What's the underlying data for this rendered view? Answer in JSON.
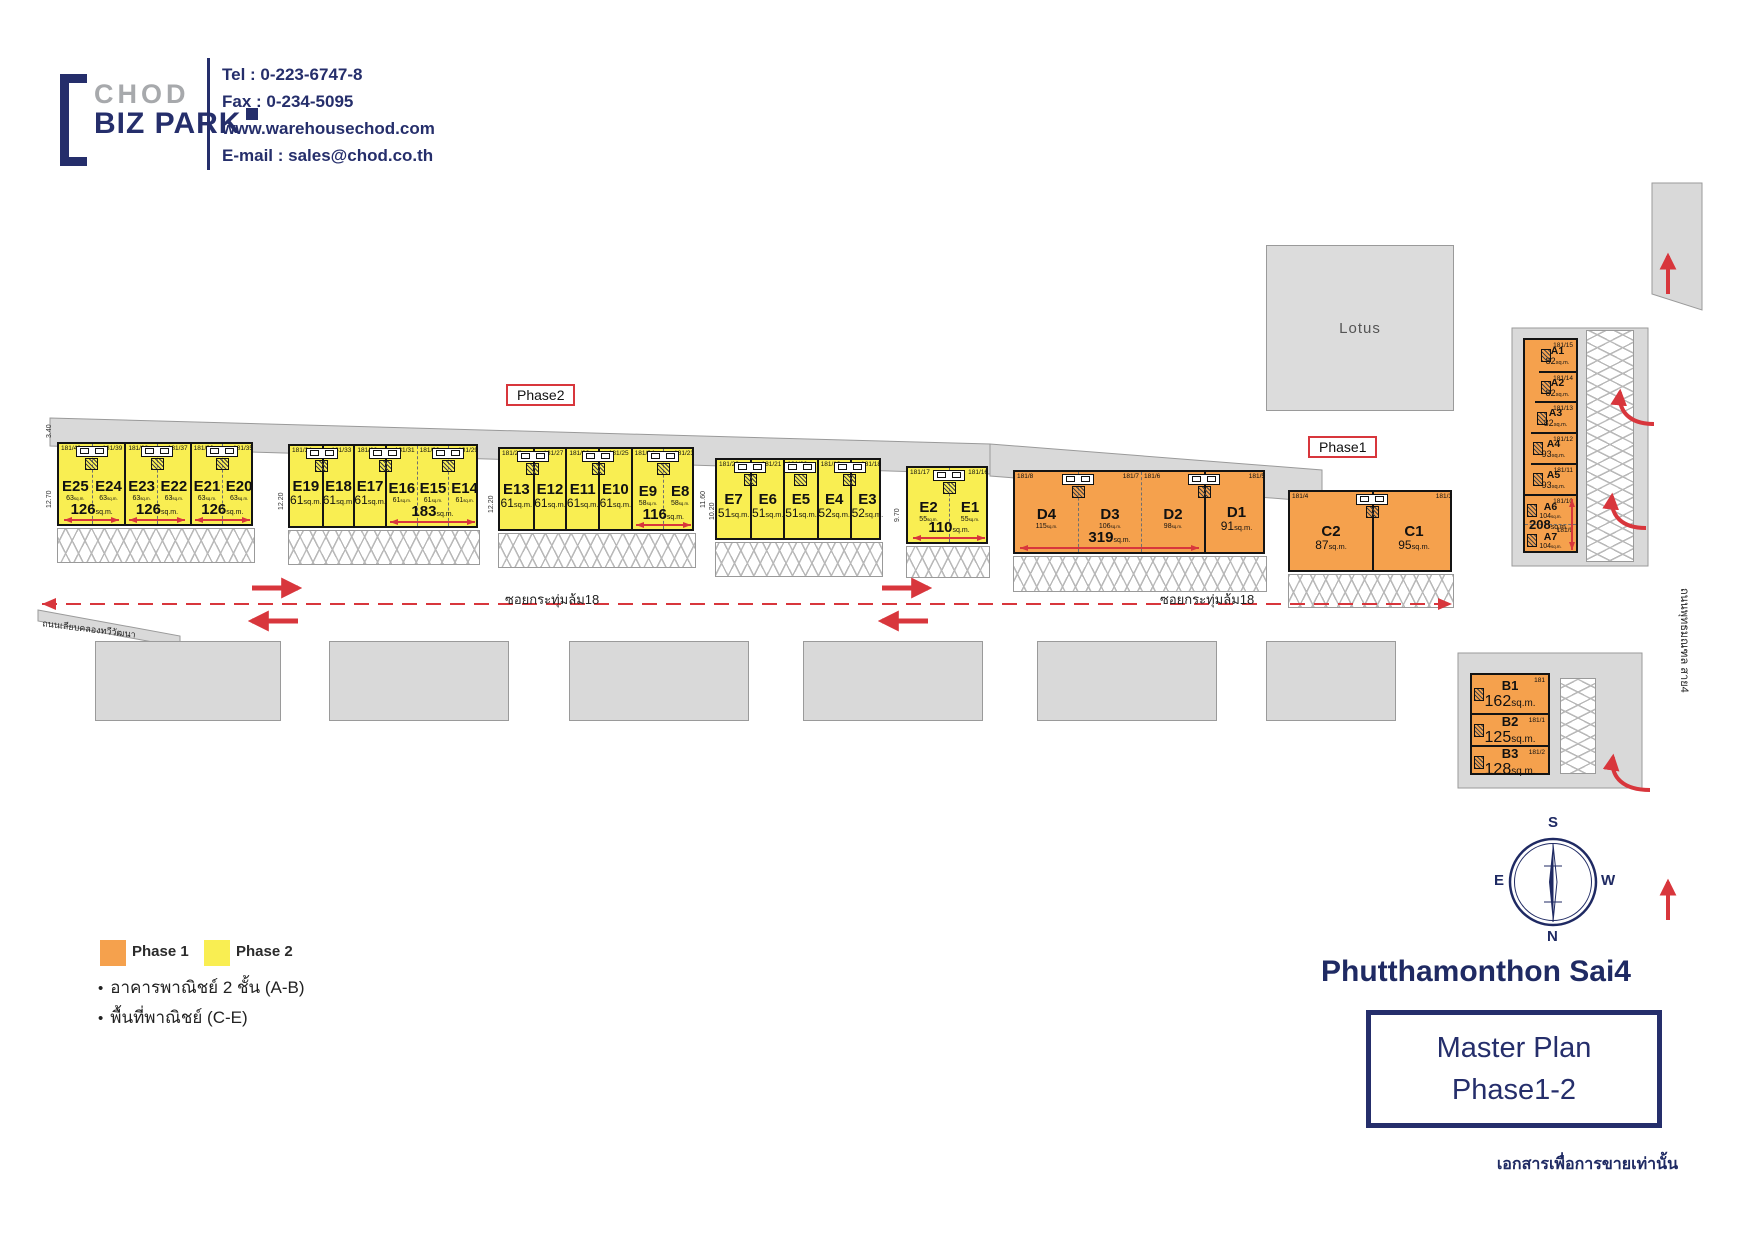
{
  "header": {
    "brand": {
      "line1": "CHOD",
      "line2": "BIZ PARK"
    },
    "contact": {
      "tel": "Tel : 0-223-6747-8",
      "fax": "Fax : 0-234-5095",
      "web": "www.warehousechod.com",
      "email": "E-mail : sales@chod.co.th"
    }
  },
  "plan": {
    "lotus": "Lotus",
    "phase2_tag": "Phase2",
    "phase1_tag": "Phase1",
    "road_soi_left": "ซอยกระทุ่มล้ม18",
    "road_soi_right": "ซอยกระทุ่มล้ม18",
    "road_canal": "ถนนเลียบคลองทวีวัฒนา",
    "road_sai4": "ถนนพุทธมณฑล สาย4",
    "groups": [
      {
        "id": "E25-E20",
        "color": "yellow",
        "x": 57,
        "y": 442,
        "w": 196,
        "h": 84,
        "units": [
          {
            "n": "E25",
            "a": "63",
            "sz": "tiny",
            "p": "181/40",
            "ps": "l"
          },
          {
            "n": "E24",
            "a": "63",
            "sz": "tiny",
            "p": "181/39",
            "ps": "r"
          },
          {
            "n": "E23",
            "a": "63",
            "sz": "tiny",
            "p": "181/38",
            "ps": "l"
          },
          {
            "n": "E22",
            "a": "63",
            "sz": "tiny",
            "p": "181/37",
            "ps": "r"
          },
          {
            "n": "E21",
            "a": "63",
            "sz": "tiny",
            "p": "181/36",
            "ps": "l"
          },
          {
            "n": "E20",
            "a": "63",
            "sz": "tiny",
            "p": "181/35",
            "ps": "r"
          }
        ],
        "spans": [
          {
            "label": "126",
            "from": 0,
            "to": 1
          },
          {
            "label": "126",
            "from": 2,
            "to": 3
          },
          {
            "label": "126",
            "from": 4,
            "to": 5
          }
        ],
        "pairs": [
          [
            0,
            1
          ],
          [
            2,
            3
          ],
          [
            4,
            5
          ]
        ]
      },
      {
        "id": "E19-E14",
        "color": "yellow",
        "x": 288,
        "y": 444,
        "w": 190,
        "h": 84,
        "units": [
          {
            "n": "E19",
            "a": "61",
            "sz": "med",
            "p": "181/34",
            "ps": "l"
          },
          {
            "n": "E18",
            "a": "61",
            "sz": "med",
            "p": "181/33",
            "ps": "r"
          },
          {
            "n": "E17",
            "a": "61",
            "sz": "med",
            "p": "181/32",
            "ps": "l"
          },
          {
            "n": "E16",
            "a": "61",
            "sz": "tiny",
            "p": "181/31",
            "ps": "r"
          },
          {
            "n": "E15",
            "a": "61",
            "sz": "tiny",
            "p": "181/30",
            "ps": "l"
          },
          {
            "n": "E14",
            "a": "61",
            "sz": "tiny",
            "p": "181/29",
            "ps": "r"
          }
        ],
        "spans": [
          {
            "label": "183",
            "from": 3,
            "to": 5
          }
        ],
        "pairs": [
          [
            0,
            1
          ],
          [
            2,
            3
          ],
          [
            4,
            5
          ]
        ]
      },
      {
        "id": "E13-E8",
        "color": "yellow",
        "x": 498,
        "y": 447,
        "w": 196,
        "h": 84,
        "units": [
          {
            "n": "E13",
            "a": "61",
            "sz": "med",
            "p": "181/28",
            "ps": "l"
          },
          {
            "n": "E12",
            "a": "61",
            "sz": "med",
            "p": "181/27",
            "ps": "r"
          },
          {
            "n": "E11",
            "a": "61",
            "sz": "med",
            "p": "181/26",
            "ps": "l"
          },
          {
            "n": "E10",
            "a": "61",
            "sz": "med",
            "p": "181/25",
            "ps": "r"
          },
          {
            "n": "E9",
            "a": "58",
            "sz": "tiny",
            "p": "181/24",
            "ps": "l"
          },
          {
            "n": "E8",
            "a": "58",
            "sz": "tiny",
            "p": "181/23",
            "ps": "r"
          }
        ],
        "spans": [
          {
            "label": "116",
            "from": 4,
            "to": 5
          }
        ],
        "pairs": [
          [
            0,
            1
          ],
          [
            2,
            3
          ],
          [
            4,
            5
          ]
        ]
      },
      {
        "id": "E7-E3",
        "color": "yellow",
        "x": 715,
        "y": 458,
        "w": 166,
        "h": 82,
        "units": [
          {
            "n": "E7",
            "a": "51",
            "sz": "med",
            "p": "181/22",
            "ps": "l"
          },
          {
            "n": "E6",
            "a": "51",
            "sz": "med",
            "p": "181/21",
            "ps": "r"
          },
          {
            "n": "E5",
            "a": "51",
            "sz": "med",
            "p": "181/20",
            "ps": "l"
          },
          {
            "n": "E4",
            "a": "52",
            "sz": "med",
            "p": "181/19",
            "ps": "l"
          },
          {
            "n": "E3",
            "a": "52",
            "sz": "med",
            "p": "181/18",
            "ps": "r"
          }
        ],
        "spans": [],
        "pairs": [
          [
            0,
            1
          ],
          [
            2
          ],
          [
            3,
            4
          ]
        ]
      },
      {
        "id": "E2-E1",
        "color": "yellow",
        "x": 906,
        "y": 466,
        "w": 82,
        "h": 78,
        "units": [
          {
            "n": "E2",
            "a": "55",
            "sz": "tiny",
            "p": "181/17",
            "ps": "l"
          },
          {
            "n": "E1",
            "a": "55",
            "sz": "tiny",
            "p": "181/16",
            "ps": "r"
          }
        ],
        "spans": [
          {
            "label": "110",
            "from": 0,
            "to": 1
          }
        ],
        "pairs": [
          [
            0,
            1
          ]
        ]
      },
      {
        "id": "D4-D1",
        "color": "orange",
        "x": 1013,
        "y": 470,
        "w": 252,
        "h": 84,
        "units": [
          {
            "n": "D4",
            "a": "115",
            "sz": "tiny",
            "p": "181/8",
            "ps": "l"
          },
          {
            "n": "D3",
            "a": "106",
            "sz": "tiny",
            "p": "181/7",
            "ps": "r"
          },
          {
            "n": "D2",
            "a": "98",
            "sz": "tiny",
            "p": "181/6",
            "ps": "l"
          },
          {
            "n": "D1",
            "a": "91",
            "sz": "med",
            "p": "181/5",
            "ps": "r"
          }
        ],
        "spans": [
          {
            "label": "319",
            "from": 0,
            "to": 2
          }
        ],
        "pairs": [
          [
            0,
            1
          ],
          [
            2,
            3
          ]
        ]
      },
      {
        "id": "C2-C1",
        "color": "orange",
        "x": 1288,
        "y": 490,
        "w": 164,
        "h": 82,
        "units": [
          {
            "n": "C2",
            "a": "87",
            "sz": "med",
            "p": "181/4",
            "ps": "l"
          },
          {
            "n": "C1",
            "a": "95",
            "sz": "med",
            "p": "181/3",
            "ps": "r"
          }
        ],
        "spans": [],
        "pairs": [
          [
            0,
            1
          ]
        ]
      },
      {
        "id": "A1-A7",
        "color": "orange",
        "dir": "v",
        "cls": "cA",
        "x": 1523,
        "y": 338,
        "w": 55,
        "h": 215,
        "units": [
          {
            "n": "A1",
            "a": "82",
            "sz": "sm",
            "p": "181/15",
            "ps": "r",
            "dx": 14
          },
          {
            "n": "A2",
            "a": "82",
            "sz": "sm",
            "p": "181/14",
            "ps": "r",
            "dx": 14
          },
          {
            "n": "A3",
            "a": "82",
            "sz": "sm",
            "p": "181/13",
            "ps": "r",
            "dx": 10
          },
          {
            "n": "A4",
            "a": "93",
            "sz": "sm",
            "p": "181/12",
            "ps": "r",
            "dx": 6
          },
          {
            "n": "A5",
            "a": "93",
            "sz": "sm",
            "p": "181/11",
            "ps": "r",
            "dx": 6
          },
          {
            "n": "A6",
            "a": "104",
            "sz": "tiny",
            "p": "181/10",
            "ps": "r",
            "dx": 0
          },
          {
            "n": "A7",
            "a": "104",
            "sz": "tiny",
            "p": "181/9",
            "ps": "r",
            "dx": 0
          }
        ],
        "spans": [
          {
            "label": "208",
            "from": 5,
            "to": 6
          }
        ],
        "pairs": []
      },
      {
        "id": "B1-B3",
        "color": "orange",
        "dir": "v",
        "cls": "cB",
        "x": 1470,
        "y": 673,
        "w": 80,
        "h": 102,
        "units": [
          {
            "n": "B1",
            "a": "162",
            "sz": "big",
            "p": "181",
            "ps": "r",
            "hh": 38
          },
          {
            "n": "B2",
            "a": "125",
            "sz": "big",
            "p": "181/1",
            "ps": "r",
            "hh": 32
          },
          {
            "n": "B3",
            "a": "128",
            "sz": "big",
            "p": "181/2",
            "ps": "r",
            "hh": 32
          }
        ],
        "spans": [],
        "pairs": []
      }
    ],
    "parking": [
      {
        "x": 57,
        "y": 528,
        "w": 196,
        "h": 33,
        "dir": "h"
      },
      {
        "x": 288,
        "y": 530,
        "w": 190,
        "h": 33,
        "dir": "h"
      },
      {
        "x": 498,
        "y": 533,
        "w": 196,
        "h": 33,
        "dir": "h"
      },
      {
        "x": 715,
        "y": 542,
        "w": 166,
        "h": 33,
        "dir": "h"
      },
      {
        "x": 906,
        "y": 546,
        "w": 82,
        "h": 30,
        "dir": "h"
      },
      {
        "x": 1013,
        "y": 556,
        "w": 252,
        "h": 34,
        "dir": "h"
      },
      {
        "x": 1288,
        "y": 574,
        "w": 164,
        "h": 32,
        "dir": "h"
      },
      {
        "x": 1586,
        "y": 330,
        "w": 46,
        "h": 230,
        "dir": "v"
      },
      {
        "x": 1560,
        "y": 678,
        "w": 34,
        "h": 94,
        "dir": "v"
      }
    ],
    "south_buildings": [
      {
        "x": 95,
        "y": 641,
        "w": 184,
        "h": 78
      },
      {
        "x": 329,
        "y": 641,
        "w": 178,
        "h": 78
      },
      {
        "x": 569,
        "y": 641,
        "w": 178,
        "h": 78
      },
      {
        "x": 803,
        "y": 641,
        "w": 178,
        "h": 78
      },
      {
        "x": 1037,
        "y": 641,
        "w": 178,
        "h": 78
      },
      {
        "x": 1266,
        "y": 641,
        "w": 128,
        "h": 78
      }
    ],
    "dimensions": [
      {
        "v": "3.40",
        "x": 46,
        "y": 438
      },
      {
        "v": "12.70",
        "x": 46,
        "y": 508
      },
      {
        "v": "12.20",
        "x": 278,
        "y": 510
      },
      {
        "v": "12.20",
        "x": 488,
        "y": 513
      },
      {
        "v": "11.60",
        "x": 700,
        "y": 508
      },
      {
        "v": "10.20",
        "x": 709,
        "y": 520
      },
      {
        "v": "9.70",
        "x": 894,
        "y": 522
      }
    ]
  },
  "legend": {
    "phase1": "Phase 1",
    "phase2": "Phase 2",
    "bullet1": "อาคารพาณิชย์ 2 ชั้น (A-B)",
    "bullet2": "พื้นที่พาณิชย์ (C-E)"
  },
  "compass": {
    "top": "S",
    "left": "E",
    "right": "W",
    "bottom": "N"
  },
  "title": {
    "area": "Phutthamonthon Sai4",
    "line1": "Master Plan",
    "line2": "Phase1-2",
    "note": "เอกสารเพื่อการขายเท่านั้น"
  },
  "colors": {
    "phase1": "#F5A14D",
    "phase2": "#F9EE52",
    "navy": "#252E6B",
    "red": "#D8363C"
  }
}
